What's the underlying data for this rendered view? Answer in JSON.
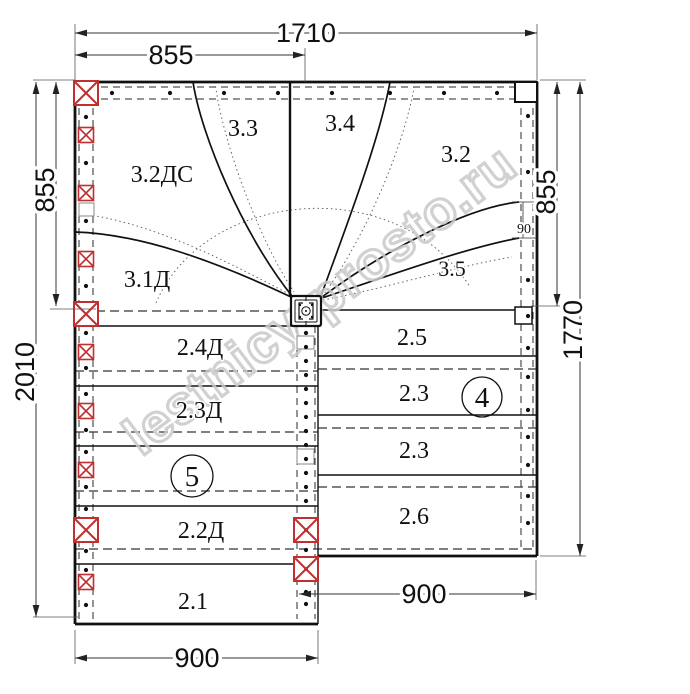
{
  "drawing": {
    "dimensions": {
      "total_width": "1710",
      "upper_left_width": "855",
      "left_height_upper": "855",
      "left_height_total": "2010",
      "right_height_upper": "855",
      "right_height_total": "1770",
      "lower_left_width": "900",
      "lower_right_width": "900",
      "winder_step_width": "90"
    },
    "steps": {
      "s32ds": "3.2ДС",
      "s33": "3.3",
      "s34": "3.4",
      "s32": "3.2",
      "s31d": "3.1Д",
      "s35": "3.5",
      "s25": "2.5",
      "s23a": "2.3",
      "s23b": "2.3",
      "s26": "2.6",
      "s24d": "2.4Д",
      "s23d": "2.3Д",
      "s22d": "2.2Д",
      "s21": "2.1"
    },
    "callouts": {
      "left_flight": "5",
      "right_flight": "4"
    },
    "watermark": "lestnicy-prosto.ru",
    "colors": {
      "post_red": "#c03030",
      "line_black": "#111111",
      "watermark_grey": "#c9c9c9"
    }
  }
}
